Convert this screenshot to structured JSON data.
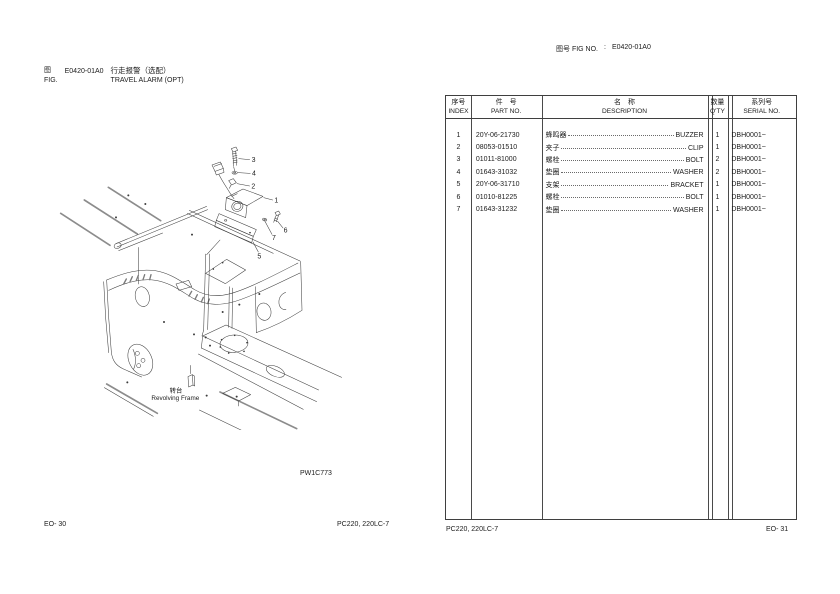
{
  "page": {
    "left_header": {
      "zh_fig": "图",
      "en_fig": "FIG.",
      "fig_no": "E0420-01A0",
      "title_zh": "行走报警（选配）",
      "title_en": "TRAVEL ALARM (OPT)"
    },
    "right_header": {
      "label": "图号  FIG NO.",
      "separator": ":",
      "value": "E0420-01A0"
    },
    "footer": {
      "left_page_no": "EO- 30",
      "left_model": "PC220, 220LC-7",
      "right_model": "PC220, 220LC-7",
      "right_page_no": "EO- 31"
    }
  },
  "diagram": {
    "drawing_no": "PW1C773",
    "frame_label_zh": "转台",
    "frame_label_en": "Revolving Frame",
    "callouts": [
      "1",
      "2",
      "3",
      "4",
      "5",
      "6",
      "7"
    ]
  },
  "table": {
    "headers": {
      "index_zh": "序号",
      "index_en": "INDEX",
      "part_zh": "件　号",
      "part_en": "PART NO.",
      "desc_zh": "名　称",
      "desc_en": "DESCRIPTION",
      "qty_zh": "数量",
      "qty_en": "Q'TY",
      "serial_zh": "系列号",
      "serial_en": "SERIAL NO."
    },
    "rows": [
      {
        "index": "1",
        "part_no": "20Y-06-21730",
        "desc_zh": "蜂鸣器",
        "desc_en": "BUZZER",
        "qty": "1",
        "serial": "DBH0001~"
      },
      {
        "index": "2",
        "part_no": "08053-01510",
        "desc_zh": "夹子",
        "desc_en": "CLIP",
        "qty": "1",
        "serial": "DBH0001~"
      },
      {
        "index": "3",
        "part_no": "01011-81000",
        "desc_zh": "螺栓",
        "desc_en": "BOLT",
        "qty": "2",
        "serial": "DBH0001~"
      },
      {
        "index": "4",
        "part_no": "01643-31032",
        "desc_zh": "垫圈",
        "desc_en": "WASHER",
        "qty": "2",
        "serial": "DBH0001~"
      },
      {
        "index": "5",
        "part_no": "20Y-06-31710",
        "desc_zh": "支架",
        "desc_en": "BRACKET",
        "qty": "1",
        "serial": "DBH0001~"
      },
      {
        "index": "6",
        "part_no": "01010-81225",
        "desc_zh": "螺栓",
        "desc_en": "BOLT",
        "qty": "1",
        "serial": "DBH0001~"
      },
      {
        "index": "7",
        "part_no": "01643-31232",
        "desc_zh": "垫圈",
        "desc_en": "WASHER",
        "qty": "1",
        "serial": "DBH0001~"
      }
    ]
  }
}
